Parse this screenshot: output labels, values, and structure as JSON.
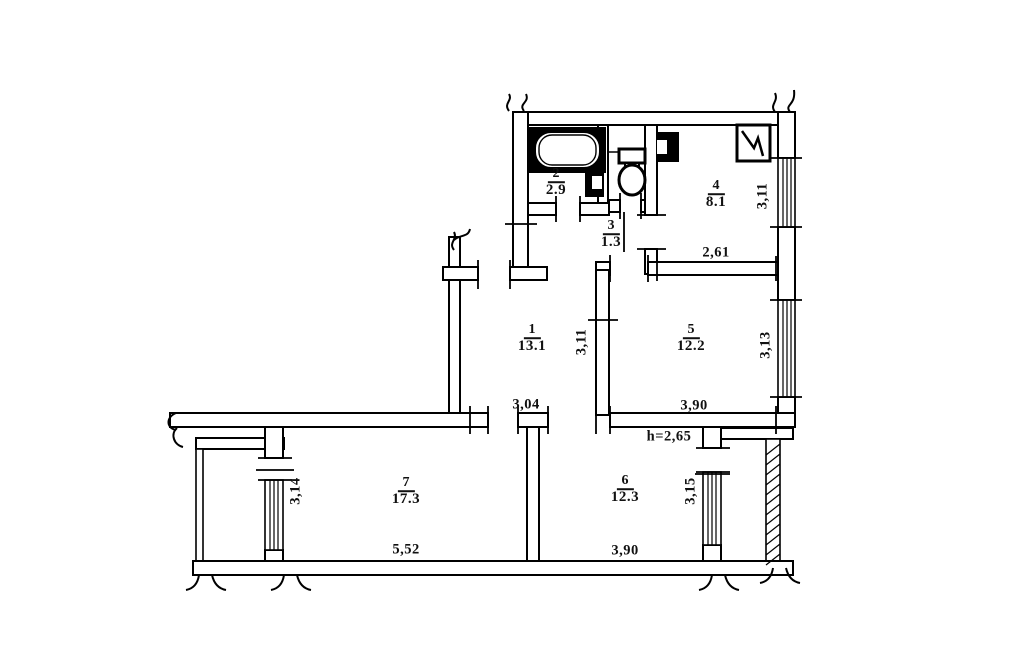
{
  "plan": {
    "rooms": {
      "r1": {
        "num": "1",
        "area": "13.1"
      },
      "r2": {
        "num": "2",
        "area": "2.9"
      },
      "r3": {
        "num": "3",
        "area": "1.3"
      },
      "r4": {
        "num": "4",
        "area": "8.1"
      },
      "r5": {
        "num": "5",
        "area": "12.2"
      },
      "r6": {
        "num": "6",
        "area": "12.3"
      },
      "r7": {
        "num": "7",
        "area": "17.3"
      }
    },
    "dimensions": {
      "kitchen_width": "2,61",
      "kitchen_depth": "3,11",
      "room5_width": "3,90",
      "room5_depth": "3,13",
      "room1_width": "3,04",
      "hall_depth": "3,11",
      "ceiling_height": "h=2,65",
      "room7_width": "5,52",
      "room7_depth": "3,14",
      "room6_width": "3,90",
      "room6_depth": "3,15"
    },
    "icons": {
      "bathtub": "bathtub-icon",
      "toilet": "toilet-icon",
      "stove": "stove-icon",
      "vent": "vent-shaft-icon"
    }
  }
}
